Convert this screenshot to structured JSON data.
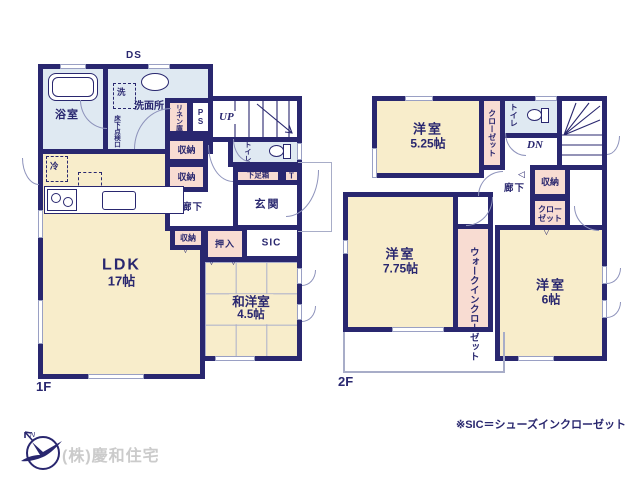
{
  "colors": {
    "wall": "#29276f",
    "room_cream": "#f8edcb",
    "wet_blue": "#dfe9f2",
    "storage_pink": "#f8dcd2",
    "text": "#29276f",
    "company_gray": "#cbcbcb"
  },
  "f1": {
    "floor_label": "1F",
    "ds": "DS",
    "up": "UP",
    "bath": "浴室",
    "washer": "洗",
    "washroom": "洗面所",
    "floor_hatch": "床下点検口",
    "linen": "リネン庫",
    "ps": "PS",
    "toilet": "トイレ",
    "shoe_box": "下足箱",
    "shoe_box_t": "T",
    "entrance": "玄関",
    "sic": "SIC",
    "hall": "廊下",
    "storage_a": "収納",
    "storage_b": "収納",
    "storage_c": "収納",
    "oshiire": "押入",
    "fridge": "冷",
    "ldk": "LDK",
    "ldk_size": "17帖",
    "washitsu": "和洋室",
    "washitsu_size": "4.5帖"
  },
  "f2": {
    "floor_label": "2F",
    "dn": "DN",
    "toilet": "トイレ",
    "hall": "廊下",
    "storage": "収納",
    "closet_a": "クローゼット",
    "closet_b": "クローゼット",
    "wic": "ウォークインクローゼット",
    "bedroom1": "洋室",
    "bedroom1_size": "5.25帖",
    "bedroom2": "洋室",
    "bedroom2_size": "7.75帖",
    "bedroom3": "洋室",
    "bedroom3_size": "6帖"
  },
  "icons": {
    "swing_down": "▽",
    "swing_left": "◁"
  },
  "footer": {
    "note": "※SIC＝シューズインクローゼット",
    "company": "(株)慶和住宅",
    "north": "N"
  }
}
